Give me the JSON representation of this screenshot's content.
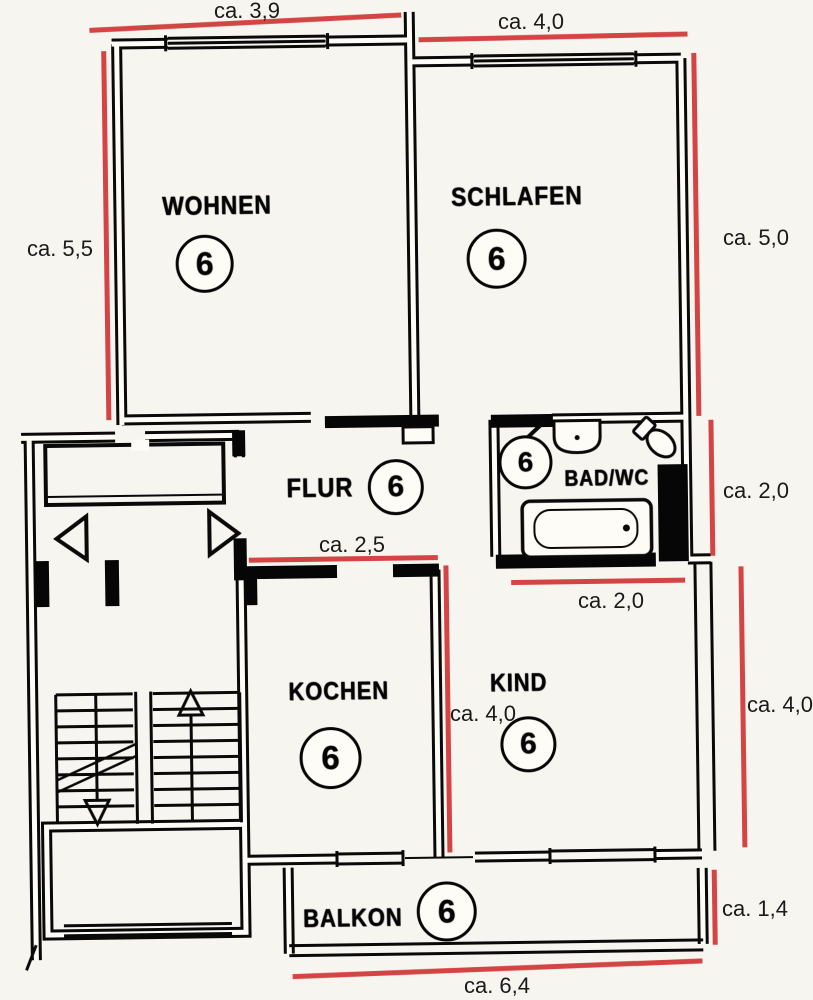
{
  "floorplan": {
    "rooms": [
      {
        "id": "wohnen",
        "name": "WOHNEN",
        "number": "6"
      },
      {
        "id": "schlafen",
        "name": "SCHLAFEN",
        "number": "6"
      },
      {
        "id": "flur",
        "name": "FLUR",
        "number": "6"
      },
      {
        "id": "bad-wc",
        "name": "BAD/WC",
        "number": "6"
      },
      {
        "id": "kochen",
        "name": "KOCHEN",
        "number": "6"
      },
      {
        "id": "kind",
        "name": "KIND",
        "number": "6"
      },
      {
        "id": "balkon",
        "name": "BALKON",
        "number": "6"
      }
    ],
    "measurements": [
      {
        "id": "top-left",
        "label": "ca. 3,9"
      },
      {
        "id": "top-right",
        "label": "ca. 4,0"
      },
      {
        "id": "left",
        "label": "ca. 5,5"
      },
      {
        "id": "right-upper",
        "label": "ca. 5,0"
      },
      {
        "id": "right-bath",
        "label": "ca. 2,0"
      },
      {
        "id": "hall-kitchen",
        "label": "ca. 2,5"
      },
      {
        "id": "below-bath",
        "label": "ca. 2,0"
      },
      {
        "id": "kitchen-center",
        "label": "ca. 4,0"
      },
      {
        "id": "right-kind",
        "label": "ca. 4,0"
      },
      {
        "id": "right-balcony",
        "label": "ca. 1,4"
      },
      {
        "id": "bottom",
        "label": "ca. 6,4"
      }
    ],
    "colors": {
      "measure_line": "#cd3a3a",
      "ink": "#101010",
      "paper": "#f7f5ef"
    }
  }
}
